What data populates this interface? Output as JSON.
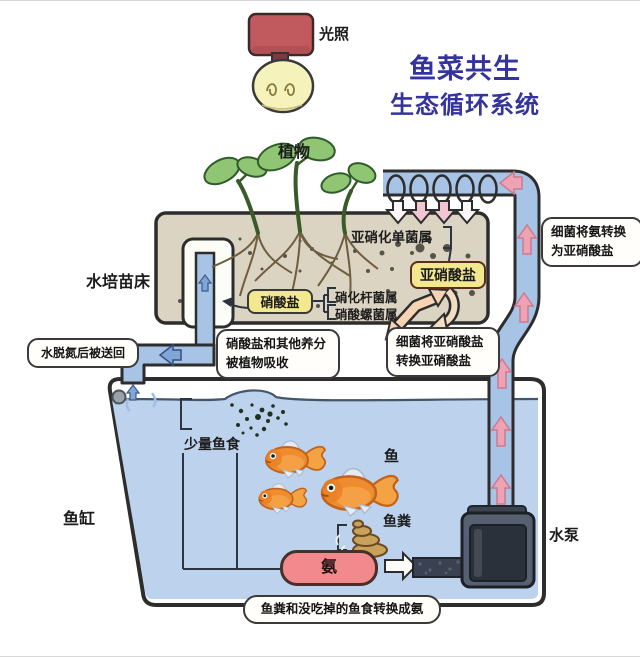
{
  "title": {
    "line1": "鱼菜共生",
    "line2": "生态循环系统"
  },
  "labels": {
    "light": "光照",
    "plants": "植物",
    "grow_bed": "水培苗床",
    "nitrosomonas": "亚硝化单菌属",
    "nitrite": "亚硝酸盐",
    "nitrate": "硝酸盐",
    "nitrobacter": "硝化杆菌属",
    "nitrospira": "硝酸螺菌属",
    "fish_food": "少量鱼食",
    "fish": "鱼",
    "fish_waste": "鱼粪",
    "fish_tank": "鱼缸",
    "ammonia": "氨",
    "water_pump": "水泵"
  },
  "callouts": {
    "water_return": "水脱氮后被送回",
    "nutrient_absorb_line1": "硝酸盐和其他养分",
    "nutrient_absorb_line2": "被植物吸收",
    "nitrite_convert_line1": "细菌将亚硝酸盐",
    "nitrite_convert_line2": "转换亚硝酸盐",
    "ammonia_convert_line1": "细菌将氨转换",
    "ammonia_convert_line2": "为亚硝酸盐",
    "waste_to_ammonia": "鱼粪和没吃掉的鱼食转换成氨"
  },
  "colors": {
    "title_blue": "#34349c",
    "lamp_red": "#c15a5e",
    "bulb_yellow": "#f6f2bc",
    "leaf_green": "#8fc573",
    "bed_tan": "#dcd4c2",
    "water_blue": "#bdd2ec",
    "pipe_blue": "#a7c3e6",
    "arrow_pink": "#eda3b3",
    "chip_yellow": "#f2e88e",
    "ammonia_pink": "#f2898c",
    "peach": "#f5d3b3",
    "pump_gray": "#566070",
    "ink": "#2d2d2d"
  }
}
